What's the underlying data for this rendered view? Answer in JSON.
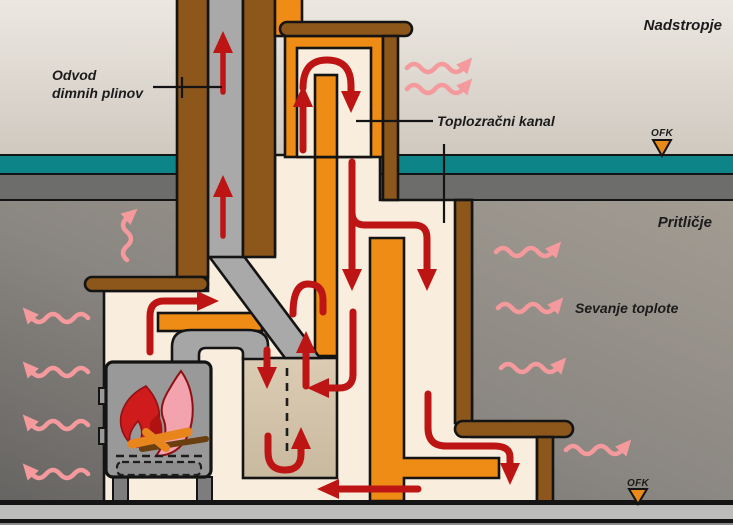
{
  "diagram": {
    "title_context": "Warm-air masonry heater airflow diagram",
    "labels": {
      "flue_gas_line1": "Odvod",
      "flue_gas_line2": "dimnih plinov",
      "warm_air_channel": "Toplozračni kanal",
      "upper_floor": "Nadstropje",
      "ground_floor": "Pritličje",
      "heat_radiation": "Sevanje toplote",
      "ofk_upper": "OFK",
      "ofk_lower": "OFK"
    },
    "colors": {
      "masonry_orange": "#ef8c15",
      "wood_brown": "#8d571b",
      "flue_gray": "#a9a9a9",
      "stove_gray": "#999999",
      "air_channel_cream": "#f9eedd",
      "bypass_chamber_tan": "#d8c9b0",
      "hot_flow_red": "#bd1414",
      "radiation_pink": "#f49a9d",
      "floor_teal": "#0d8487",
      "slab_gray": "#6d6d6b",
      "fire_pink": "#f2a3ad",
      "fire_red": "#cf1b1b"
    }
  }
}
